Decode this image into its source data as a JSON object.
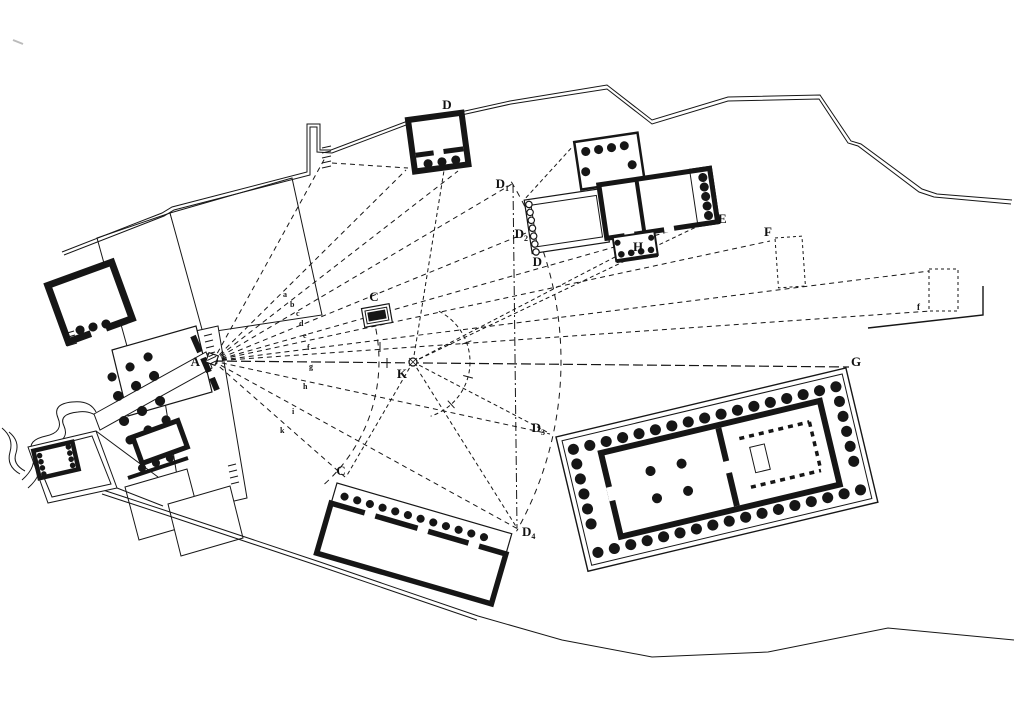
{
  "figure_type": "acropolis-site-plan-sightline-diagram",
  "colors": {
    "ink": "#161616",
    "background": "#ffffff"
  },
  "points": [
    {
      "id": "A",
      "text": "A",
      "sub": ""
    },
    {
      "id": "C-altar",
      "text": "C",
      "sub": ""
    },
    {
      "id": "D-top-building",
      "text": "D",
      "sub": ""
    },
    {
      "id": "D1",
      "text": "D",
      "sub": "1"
    },
    {
      "id": "D2",
      "text": "D",
      "sub": "2"
    },
    {
      "id": "D-arc",
      "text": "D",
      "sub": ""
    },
    {
      "id": "D3",
      "text": "D",
      "sub": "3"
    },
    {
      "id": "D4",
      "text": "D",
      "sub": "4"
    },
    {
      "id": "E",
      "text": "E",
      "sub": ""
    },
    {
      "id": "H",
      "text": "H",
      "sub": ""
    },
    {
      "id": "F",
      "text": "F",
      "sub": ""
    },
    {
      "id": "f-terrace-end",
      "text": "f",
      "sub": ""
    },
    {
      "id": "G",
      "text": "G",
      "sub": ""
    },
    {
      "id": "K",
      "text": "K",
      "sub": ""
    },
    {
      "id": "C-chalkotheke",
      "text": "C",
      "sub": ""
    }
  ],
  "ray_labels": [
    {
      "text": "a"
    },
    {
      "text": "b"
    },
    {
      "text": "c"
    },
    {
      "text": "d"
    },
    {
      "text": "e"
    },
    {
      "text": "f"
    },
    {
      "text": "g"
    },
    {
      "text": "h"
    },
    {
      "text": "i"
    },
    {
      "text": "k"
    }
  ]
}
